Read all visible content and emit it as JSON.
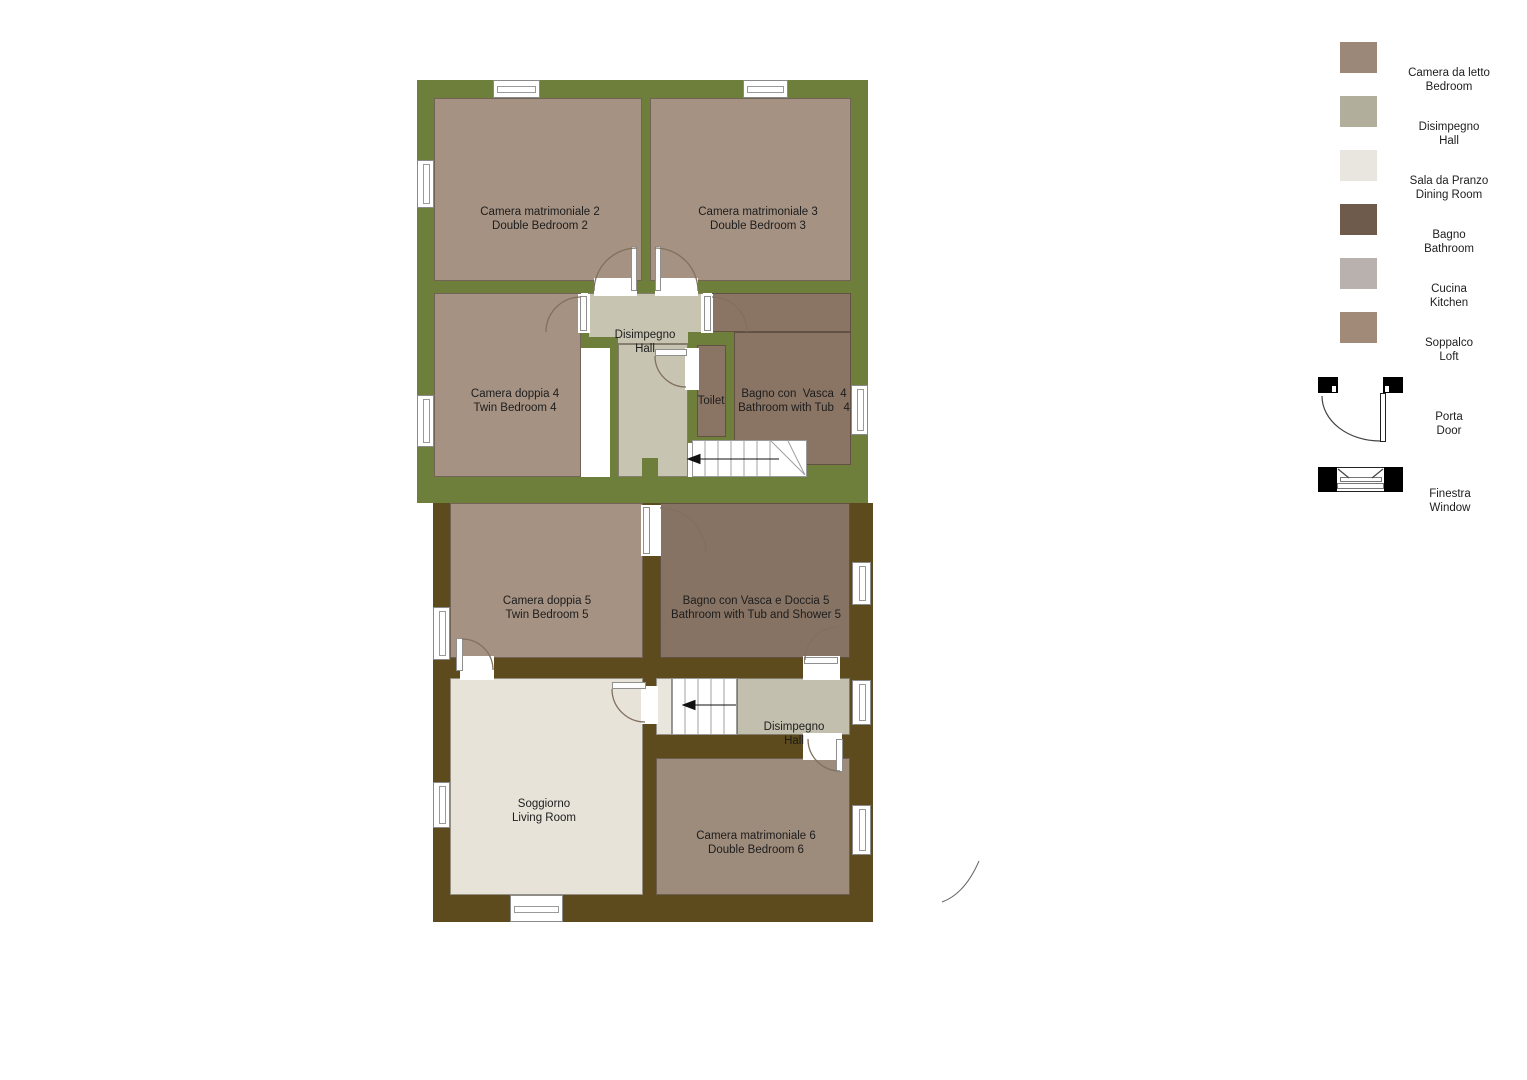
{
  "palette": {
    "wall_green": "#6e7f3c",
    "wall_brown": "#5d4a1d",
    "bedroom_fill": "#a59283",
    "bedroom6_fill": "#9d8b7b",
    "bathroom_fill": "#8a7464",
    "bathroom5_fill": "#867363",
    "hall_upper_fill": "#c8c4b2",
    "hall_lower_fill": "#c3bfae",
    "landing_fill": "#e9e6de",
    "living_fill": "#e7e3d9",
    "stairs_fill": "#ffffff"
  },
  "rooms": {
    "bedroom2": {
      "it": "Camera matrimoniale 2",
      "en": "Double Bedroom 2"
    },
    "bedroom3": {
      "it": "Camera matrimoniale 3",
      "en": "Double Bedroom 3"
    },
    "hall_upper": {
      "it": "Disimpegno",
      "en": "Hall"
    },
    "bedroom4": {
      "it": "Camera doppia 4",
      "en": "Twin Bedroom 4"
    },
    "toilet": {
      "label": "Toilet"
    },
    "bathroom4": {
      "it": "Bagno con  Vasca  4",
      "en": "Bathroom with Tub   4"
    },
    "bedroom5": {
      "it": "Camera doppia 5",
      "en": "Twin Bedroom 5"
    },
    "bathroom5": {
      "it": "Bagno con Vasca e Doccia 5",
      "en": "Bathroom with Tub and Shower 5"
    },
    "hall_lower": {
      "it": "Disimpegno",
      "en": "Hall"
    },
    "living": {
      "it": "Soggiorno",
      "en": "Living Room"
    },
    "bedroom6": {
      "it": "Camera matrimoniale 6",
      "en": "Double Bedroom 6"
    }
  },
  "legend": {
    "items": [
      {
        "it": "Camera da letto",
        "en": "Bedroom",
        "color": "#9b8878"
      },
      {
        "it": "Disimpegno",
        "en": "Hall",
        "color": "#b1ae9b"
      },
      {
        "it": "Sala da Pranzo",
        "en": "Dining Room",
        "color": "#e9e6df"
      },
      {
        "it": "Bagno",
        "en": "Bathroom",
        "color": "#6f5b4b"
      },
      {
        "it": "Cucina",
        "en": "Kitchen",
        "color": "#b8b1ad"
      },
      {
        "it": "Soppalco",
        "en": "Loft",
        "color": "#a18a78"
      }
    ],
    "door": {
      "it": "Porta",
      "en": "Door"
    },
    "window": {
      "it": "Finestra",
      "en": "Window"
    }
  }
}
